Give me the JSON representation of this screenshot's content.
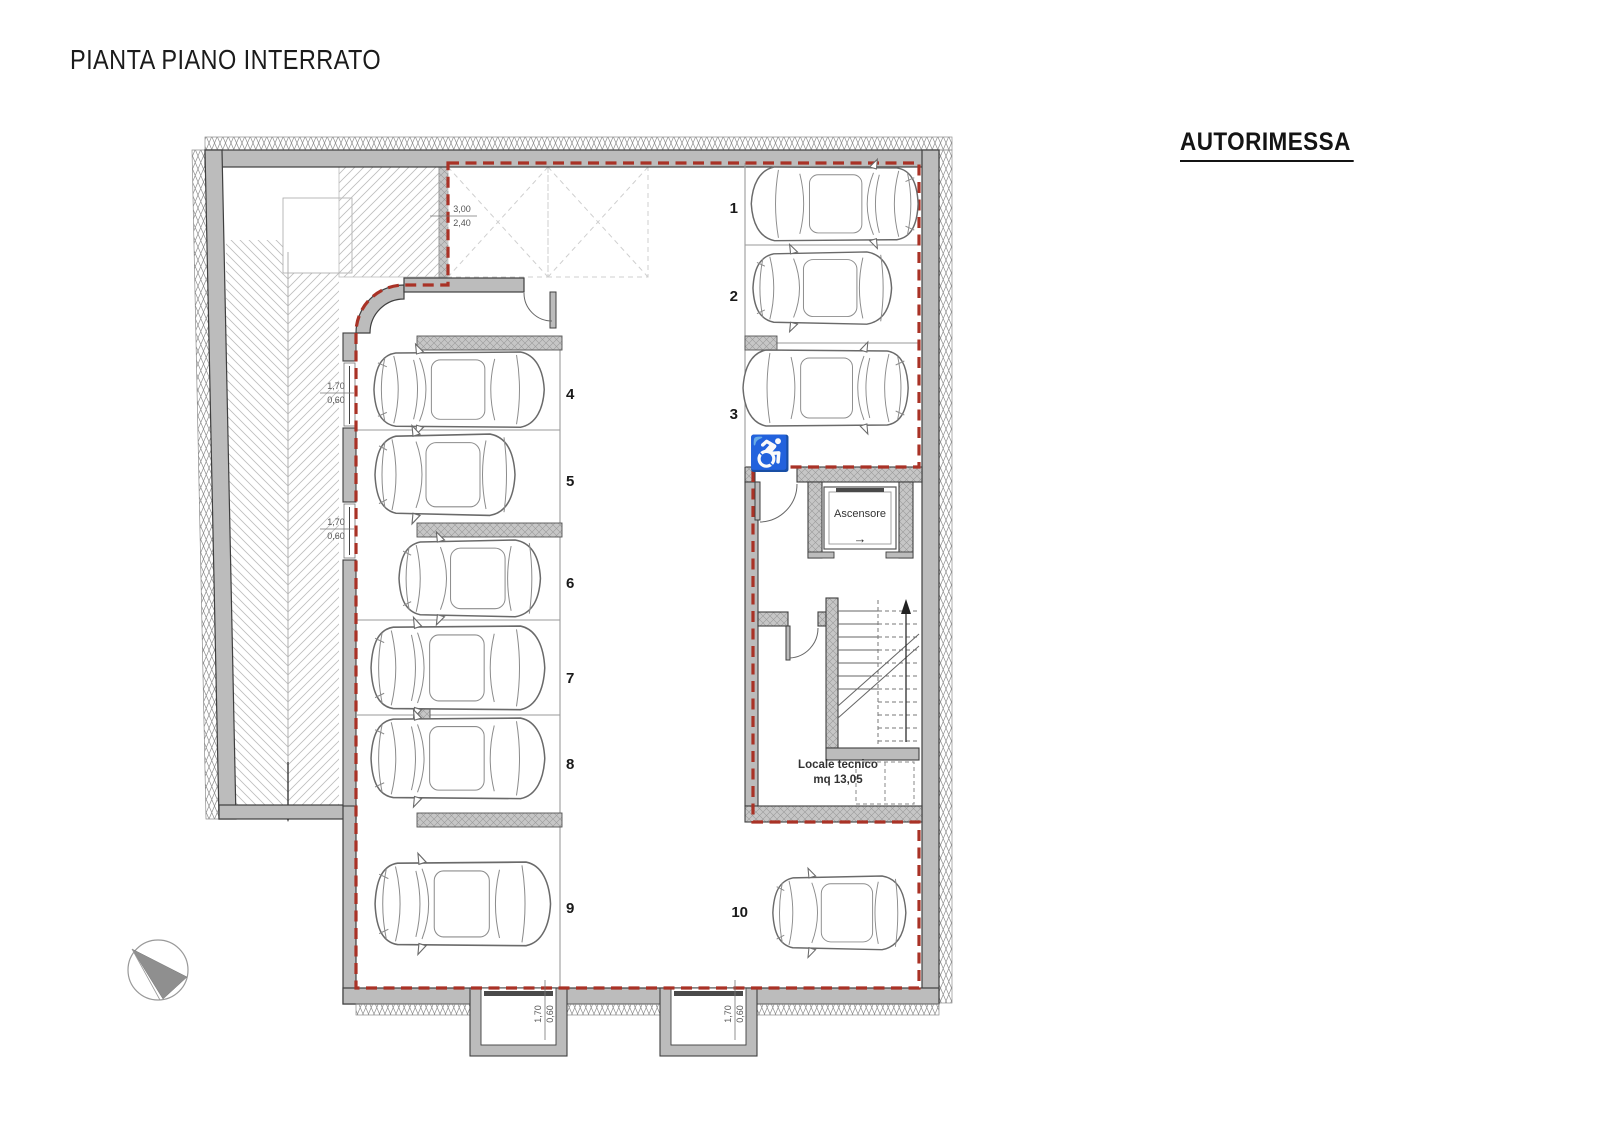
{
  "title": "PIANTA PIANO INTERRATO",
  "plan": {
    "area_label": "AUTORIMESSA",
    "parking_spots": [
      {
        "number": "1"
      },
      {
        "number": "2"
      },
      {
        "number": "3",
        "accessible": true
      },
      {
        "number": "4"
      },
      {
        "number": "5"
      },
      {
        "number": "6"
      },
      {
        "number": "7"
      },
      {
        "number": "8"
      },
      {
        "number": "9"
      },
      {
        "number": "10"
      }
    ],
    "elevator": {
      "label": "Ascensore",
      "direction_arrow": "→"
    },
    "technical_room": {
      "name": "Locale tecnico",
      "area": "mq 13,05"
    },
    "dimensions": {
      "ramp_opening": {
        "width": "3,00",
        "height": "2,40"
      },
      "vent_window": {
        "width": "1,70",
        "height": "0,60"
      }
    },
    "icons": {
      "accessible_parking": "♿"
    },
    "colors": {
      "wall_gray": "#bcbcbc",
      "compartment_boundary_red": "#a93226",
      "car_line": "#6a6a6a"
    }
  }
}
